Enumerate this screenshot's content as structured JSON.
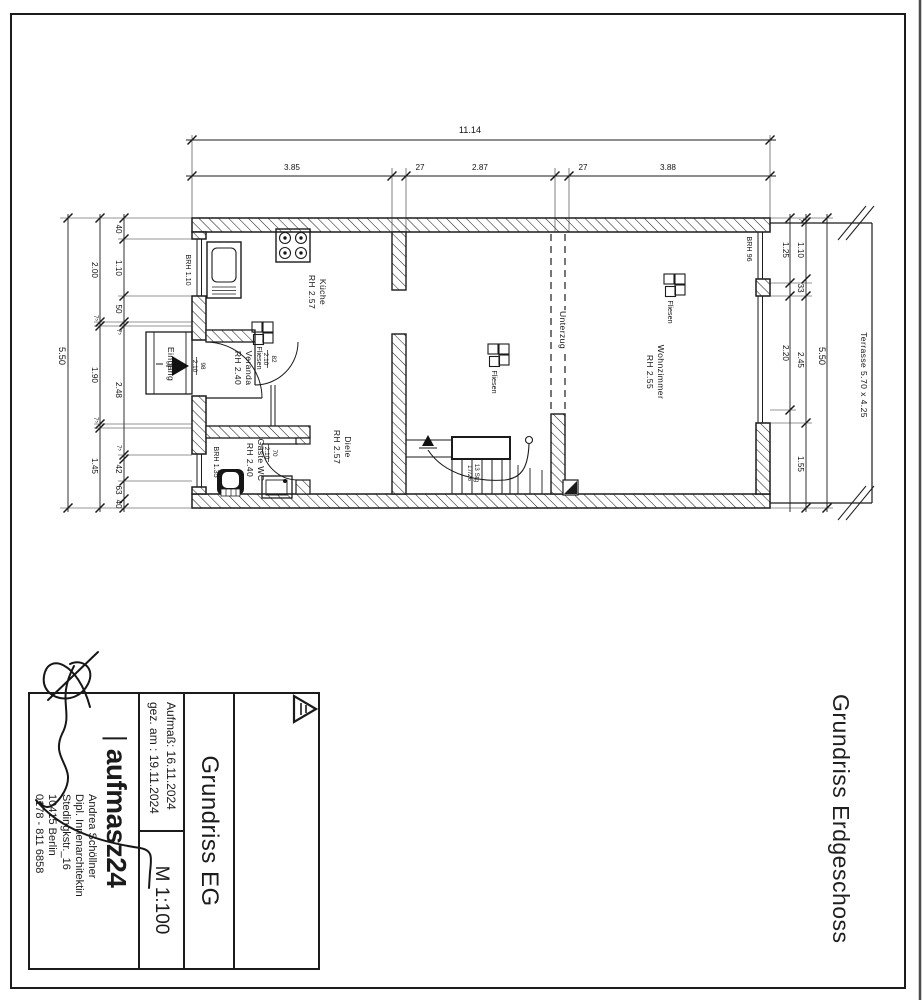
{
  "document_label": "Grundriss Erdgeschoss",
  "rooms": {
    "kueche": {
      "name": "Küche",
      "height": "RH 2.57"
    },
    "diele": {
      "name": "Diele",
      "height": "RH 2.57"
    },
    "wohnzimmer": {
      "name": "Wohnzimmer",
      "height": "RH 2.55"
    },
    "veranda": {
      "name": "Veranda",
      "height": "RH 2.40"
    },
    "gaeste_wc": {
      "name": "Gäste WC",
      "height": "RH 2.40"
    },
    "eingang_label": "Eingang"
  },
  "floor_finish_label": "Fliesen",
  "beam_label": "Unterzug",
  "terrace_label": "Terrasse 5.70 x 4.25",
  "sills": {
    "kueche": "BRH 1.10",
    "wc": "BRH 1.35",
    "wohnzimmer": "BRH 96"
  },
  "doors": {
    "eingang": {
      "width": "98",
      "height": "2.10"
    },
    "veranda": {
      "width": "82",
      "height": "2.10"
    },
    "wc": {
      "width": "70",
      "height": "2.10"
    }
  },
  "stairs": {
    "line1": "13 Stg",
    "line2": "17/26"
  },
  "dims": {
    "top": {
      "total": "11.14",
      "chain": [
        "3.85",
        "27",
        "2.87",
        "27",
        "3.88"
      ]
    },
    "left": {
      "total": "5.50",
      "chain": [
        "2.00",
        "7⁵",
        "1.90",
        "7⁵",
        "1.45"
      ],
      "inner": [
        "40",
        "1.10",
        "50",
        "7⁵",
        "2.48",
        "7⁵",
        "42",
        "63",
        "40"
      ]
    },
    "right": {
      "total": "5.50",
      "outer_chain": [
        "1.25",
        "2.20"
      ],
      "inner": [
        "7",
        "1.10",
        "33",
        "2.45",
        "1.55"
      ]
    }
  },
  "title_block": {
    "brand": "aufmasz24",
    "brand_bar": "|",
    "contact": {
      "name": "Andrea Schöllner",
      "role": "Dipl. Innenarchitektin",
      "street": "Stedingkstr._16",
      "city": "10415 Berlin",
      "phone": "0178 - 811 6858"
    },
    "drawing_title": "Grundriss EG",
    "scale": "M 1:100",
    "measured": "Aufmaß:  16.11.2024",
    "drawn": "gez. am :  19.11.2024"
  }
}
